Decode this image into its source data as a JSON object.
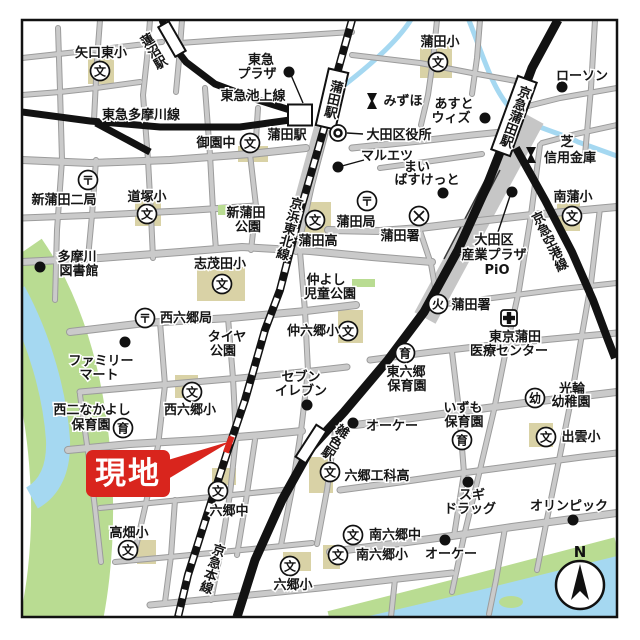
{
  "colors": {
    "water_blue": "#a5d8f1",
    "bank_green": "#b9dc92",
    "school_tan": "#d9d2a6",
    "road_fill": "#cacaca",
    "road_edge": "#9c9c9c",
    "rail_black": "#121212",
    "callout_red": "#d9251d"
  },
  "callout": {
    "label": "現地"
  },
  "compass": {
    "label": "N"
  },
  "icon_glyphs": {
    "school": "文",
    "post": "〒",
    "nursery": "育",
    "kindergarten": "幼",
    "fire": "火"
  },
  "stations": [
    {
      "name": "jr-kamata-station",
      "label": "蒲田駅",
      "cx": 332,
      "cy": 99,
      "w": 20,
      "h": 58,
      "rot": 13,
      "fs": 11.5,
      "inside": true
    },
    {
      "name": "keikyu-kamata-station",
      "label": "京急蒲田駅",
      "cx": 514,
      "cy": 116,
      "w": 20,
      "h": 78,
      "rot": 20,
      "fs": 11,
      "inside": true
    },
    {
      "name": "zoshiki-station",
      "label": "雑色駅",
      "cx": 311,
      "cy": 444,
      "w": 12,
      "h": 38,
      "rot": 33,
      "fs": 11.5,
      "lx": 334,
      "ly": 441
    },
    {
      "name": "hasunuma-station",
      "label": "蓮沼駅",
      "cx": 172,
      "cy": 39,
      "w": 12,
      "h": 34,
      "rot": -30,
      "fs": 12.5,
      "lx": 152,
      "ly": 52
    },
    {
      "name": "tokyu-kamata-station",
      "label": "蒲田駅",
      "cx": 300,
      "cy": 115,
      "w": 24,
      "h": 21,
      "rot": 0,
      "fs": 13,
      "lx": 287,
      "ly": 139,
      "horizontal": true
    }
  ],
  "rail_labels": [
    {
      "t": "東急池上線",
      "x": 253,
      "y": 100
    },
    {
      "t": "東急多摩川線",
      "x": 141,
      "y": 119
    },
    {
      "t": "京浜東北線",
      "x": 288,
      "y": 228,
      "v": true,
      "rot": 15
    },
    {
      "t": "京急空港線",
      "x": 548,
      "y": 242,
      "v": true,
      "rot": -26
    },
    {
      "t": "京急本線",
      "x": 211,
      "y": 568,
      "v": true,
      "rot": 18
    }
  ],
  "labels": [
    {
      "t": "矢口東小",
      "x": 101,
      "y": 57
    },
    {
      "t": "東急",
      "x": 261,
      "y": 64
    },
    {
      "t": "プラザ",
      "x": 257,
      "y": 78
    },
    {
      "t": "蒲田小",
      "x": 440,
      "y": 46
    },
    {
      "t": "ローソン",
      "x": 582,
      "y": 80
    },
    {
      "t": "みずほ",
      "x": 403,
      "y": 105
    },
    {
      "t": "あすと",
      "x": 454,
      "y": 108
    },
    {
      "t": "ウィズ",
      "x": 451,
      "y": 122
    },
    {
      "t": "大田区役所",
      "x": 399,
      "y": 139
    },
    {
      "t": "芝",
      "x": 567,
      "y": 146,
      "fs": 12
    },
    {
      "t": "信用金庫",
      "x": 570,
      "y": 162
    },
    {
      "t": "御園中",
      "x": 216,
      "y": 147
    },
    {
      "t": "マルエツ",
      "x": 387,
      "y": 160
    },
    {
      "t": "まい",
      "x": 417,
      "y": 171
    },
    {
      "t": "ばすけっと",
      "x": 427,
      "y": 184
    },
    {
      "t": "新蒲田二局",
      "x": 64,
      "y": 204
    },
    {
      "t": "道塚小",
      "x": 147,
      "y": 201
    },
    {
      "t": "新蒲田",
      "x": 246,
      "y": 217
    },
    {
      "t": "公園",
      "x": 248,
      "y": 231
    },
    {
      "t": "蒲田局",
      "x": 356,
      "y": 226
    },
    {
      "t": "蒲田署",
      "x": 400,
      "y": 240
    },
    {
      "t": "蒲田高",
      "x": 318,
      "y": 245
    },
    {
      "t": "南蒲小",
      "x": 573,
      "y": 201
    },
    {
      "t": "大田区",
      "x": 494,
      "y": 244
    },
    {
      "t": "産業プラザ",
      "x": 494,
      "y": 259
    },
    {
      "t": "PiO",
      "x": 497,
      "y": 274
    },
    {
      "t": "多摩川",
      "x": 77,
      "y": 261
    },
    {
      "t": "図書館",
      "x": 79,
      "y": 275
    },
    {
      "t": "志茂田小",
      "x": 220,
      "y": 268
    },
    {
      "t": "仲よし",
      "x": 326,
      "y": 284
    },
    {
      "t": "児童公園",
      "x": 330,
      "y": 298
    },
    {
      "t": "蒲田署",
      "x": 471,
      "y": 309
    },
    {
      "t": "西六郷局",
      "x": 186,
      "y": 322
    },
    {
      "t": "タイヤ",
      "x": 227,
      "y": 341
    },
    {
      "t": "公園",
      "x": 223,
      "y": 355
    },
    {
      "t": "仲六郷小",
      "x": 313,
      "y": 335
    },
    {
      "t": "東京蒲田",
      "x": 515,
      "y": 341
    },
    {
      "t": "医療センター",
      "x": 509,
      "y": 355
    },
    {
      "t": "ファミリー",
      "x": 101,
      "y": 365
    },
    {
      "t": "マート",
      "x": 99,
      "y": 379
    },
    {
      "t": "セブン",
      "x": 301,
      "y": 381
    },
    {
      "t": "イレブン",
      "x": 301,
      "y": 395
    },
    {
      "t": "東六郷",
      "x": 406,
      "y": 376
    },
    {
      "t": "保育園",
      "x": 407,
      "y": 390
    },
    {
      "t": "光輪",
      "x": 572,
      "y": 393
    },
    {
      "t": "幼稚園",
      "x": 571,
      "y": 406
    },
    {
      "t": "西二なかよし",
      "x": 92,
      "y": 414
    },
    {
      "t": "保育園",
      "x": 91,
      "y": 429
    },
    {
      "t": "西六郷小",
      "x": 190,
      "y": 414
    },
    {
      "t": "いずも",
      "x": 463,
      "y": 412
    },
    {
      "t": "保育園",
      "x": 464,
      "y": 426
    },
    {
      "t": "オーケー",
      "x": 392,
      "y": 430
    },
    {
      "t": "出雲小",
      "x": 581,
      "y": 441
    },
    {
      "t": "六郷工科高",
      "x": 377,
      "y": 480
    },
    {
      "t": "スギ",
      "x": 472,
      "y": 499
    },
    {
      "t": "ドラッグ",
      "x": 470,
      "y": 513
    },
    {
      "t": "オリンピック",
      "x": 569,
      "y": 510
    },
    {
      "t": "六郷中",
      "x": 229,
      "y": 515
    },
    {
      "t": "高畑小",
      "x": 129,
      "y": 537
    },
    {
      "t": "南六郷中",
      "x": 395,
      "y": 539
    },
    {
      "t": "南六郷小",
      "x": 382,
      "y": 559
    },
    {
      "t": "オーケー",
      "x": 451,
      "y": 558
    },
    {
      "t": "六郷小",
      "x": 293,
      "y": 589
    }
  ],
  "icons": [
    {
      "type": "school",
      "x": 100,
      "y": 71
    },
    {
      "type": "school",
      "x": 438,
      "y": 62
    },
    {
      "type": "school",
      "x": 250,
      "y": 143
    },
    {
      "type": "school",
      "x": 147,
      "y": 214
    },
    {
      "type": "school",
      "x": 315,
      "y": 220
    },
    {
      "type": "school",
      "x": 222,
      "y": 284
    },
    {
      "type": "school",
      "x": 348,
      "y": 331
    },
    {
      "type": "school",
      "x": 192,
      "y": 392
    },
    {
      "type": "school",
      "x": 572,
      "y": 216
    },
    {
      "type": "school",
      "x": 546,
      "y": 437
    },
    {
      "type": "school",
      "x": 330,
      "y": 472
    },
    {
      "type": "school",
      "x": 218,
      "y": 491
    },
    {
      "type": "school",
      "x": 128,
      "y": 550
    },
    {
      "type": "school",
      "x": 290,
      "y": 566
    },
    {
      "type": "school",
      "x": 353,
      "y": 535
    },
    {
      "type": "school",
      "x": 338,
      "y": 555
    },
    {
      "type": "post",
      "x": 88,
      "y": 180
    },
    {
      "type": "post",
      "x": 367,
      "y": 201
    },
    {
      "type": "post",
      "x": 145,
      "y": 318
    },
    {
      "type": "police",
      "x": 419,
      "y": 216
    },
    {
      "type": "fire",
      "x": 438,
      "y": 304
    },
    {
      "type": "nursery",
      "x": 123,
      "y": 428
    },
    {
      "type": "nursery",
      "x": 405,
      "y": 353
    },
    {
      "type": "nursery",
      "x": 462,
      "y": 440
    },
    {
      "type": "kindergarten",
      "x": 535,
      "y": 398
    },
    {
      "type": "gov",
      "x": 338,
      "y": 133
    },
    {
      "type": "bank",
      "x": 372,
      "y": 101
    },
    {
      "type": "bank",
      "x": 531,
      "y": 155
    },
    {
      "type": "hospital",
      "x": 509,
      "y": 318
    }
  ],
  "dots": [
    {
      "name": "tokyu-plaza-dot",
      "x": 289,
      "y": 72
    },
    {
      "name": "lawson-dot",
      "x": 562,
      "y": 87
    },
    {
      "name": "asuto-with-dot",
      "x": 485,
      "y": 118
    },
    {
      "name": "maruetsu-dot",
      "x": 338,
      "y": 167
    },
    {
      "name": "mybasket-dot",
      "x": 443,
      "y": 193
    },
    {
      "name": "pio-dot",
      "x": 512,
      "y": 192
    },
    {
      "name": "library-dot",
      "x": 40,
      "y": 267
    },
    {
      "name": "familymart-dot",
      "x": 125,
      "y": 342
    },
    {
      "name": "seveneleven-dot",
      "x": 307,
      "y": 405
    },
    {
      "name": "ok-store-dot",
      "x": 353,
      "y": 423
    },
    {
      "name": "ok-store-dot",
      "x": 445,
      "y": 540
    },
    {
      "name": "sugi-drug-dot",
      "x": 468,
      "y": 482
    },
    {
      "name": "olympic-dot",
      "x": 573,
      "y": 520
    }
  ],
  "pointer_lines": [
    {
      "x1": 291,
      "y1": 75,
      "x2": 303,
      "y2": 103
    },
    {
      "x1": 347,
      "y1": 133,
      "x2": 363,
      "y2": 134
    },
    {
      "x1": 364,
      "y1": 160,
      "x2": 342,
      "y2": 166
    },
    {
      "x1": 510,
      "y1": 196,
      "x2": 498,
      "y2": 232
    }
  ]
}
